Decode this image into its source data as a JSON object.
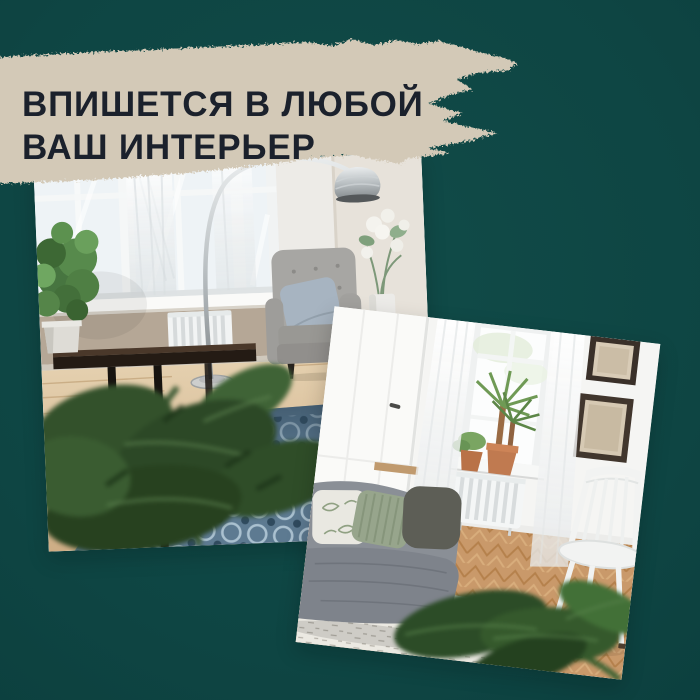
{
  "post": {
    "type": "product-promo-social-tile",
    "headline": {
      "line1": "ВПИШЕТСЯ В ЛЮБОЙ",
      "line2": "ВАШ ИНТЕРЬЕР"
    },
    "theme": {
      "background": "#114c49",
      "background_edge": "#082f2f",
      "brush": "#d3c9b7",
      "headline_text": "#1b212c"
    },
    "photos": [
      {
        "name": "photo-living-room-blue-patterned-rug",
        "alt": "Living room with large windows, arc floor lamp, gray armchair, dark console with plant, monstera foreground and blue patterned rug",
        "rotation_deg": -2.3
      },
      {
        "name": "photo-white-living-room-gray-sofa",
        "alt": "Bright white living room with gray sofa, pillows, window plants, radiator, picture frames, white chair, herringbone parquet and white rug",
        "rotation_deg": 6.6
      }
    ]
  }
}
